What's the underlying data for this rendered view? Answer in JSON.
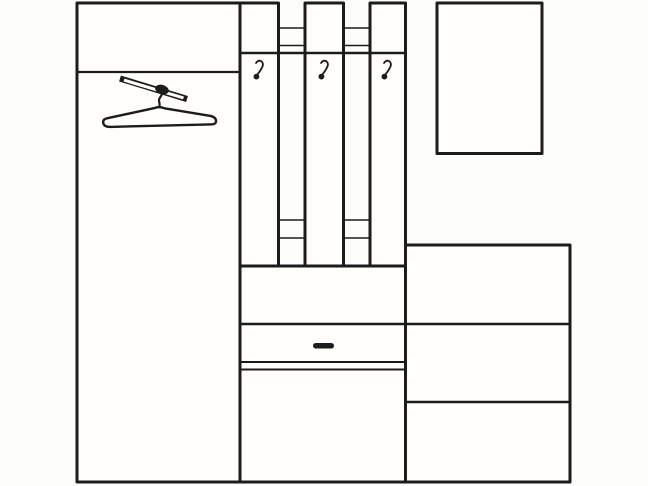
{
  "canvas": {
    "width": 648,
    "height": 486
  },
  "meta": {
    "background_color": "#fdfdfb",
    "line_color": "#1c1c1c",
    "panel_fill": "#fffefb",
    "drawing_kind": "hallway-furniture-line-drawing"
  },
  "drawing": {
    "shapes": [
      {
        "name": "wardrobe-body",
        "type": "rect",
        "x": 77,
        "y": 3,
        "w": 164,
        "h": 479,
        "sw": 3,
        "fill": "#fffefb"
      },
      {
        "name": "wardrobe-top-shelf-line",
        "type": "line",
        "x1": 77,
        "y1": 72,
        "x2": 241,
        "y2": 72,
        "sw": 2.2
      },
      {
        "name": "hanger-rod",
        "type": "line",
        "x1": 120,
        "y1": 78.5,
        "x2": 187,
        "y2": 99,
        "sw": 6.2,
        "cap": "butt"
      },
      {
        "name": "hanger-rod-core",
        "type": "line",
        "x1": 124,
        "y1": 80.1,
        "x2": 183.5,
        "y2": 97.9,
        "sw": 3,
        "cap": "butt",
        "stroke": "#fffefb"
      },
      {
        "name": "hanger-hook-collar",
        "type": "ellipse",
        "cx": 162,
        "cy": 89.5,
        "rx": 7,
        "ry": 4.6,
        "rot": 17,
        "fill": "#1c1c1c",
        "sw": 0
      },
      {
        "name": "hanger-hook-stem",
        "type": "path",
        "d": "M 161.5,92.5 C 163,96 158.5,97.5 159,100.5 C 159.4,102.8 159.8,104.5 159.6,107",
        "sw": 2.2
      },
      {
        "name": "hanger-body",
        "type": "path",
        "d": "M 107.5,118.2 L 155,107.9 Q 159.5,106.2 164.5,108.3 L 210.5,115.9 Q 216.4,117.3 216,121.6 Q 215.6,124.7 209.8,124.4 L 110.5,126.9 Q 103.6,127 103.1,122.4 Q 102.9,119.1 107.5,118.2 Z",
        "sw": 2.4,
        "fill": "#fffefb"
      },
      {
        "name": "rack-rail-top-upper-left",
        "type": "line",
        "x1": 278.5,
        "y1": 28,
        "x2": 305,
        "y2": 28,
        "sw": 1.6
      },
      {
        "name": "rack-rail-top-lower-left",
        "type": "line",
        "x1": 278.5,
        "y1": 45.5,
        "x2": 305,
        "y2": 45.5,
        "sw": 1.6
      },
      {
        "name": "rack-rail-top-upper-right",
        "type": "line",
        "x1": 343.5,
        "y1": 28,
        "x2": 370,
        "y2": 28,
        "sw": 1.6
      },
      {
        "name": "rack-rail-top-lower-right",
        "type": "line",
        "x1": 343.5,
        "y1": 45.5,
        "x2": 370,
        "y2": 45.5,
        "sw": 1.6
      },
      {
        "name": "rack-rail-bottom-upper-left",
        "type": "line",
        "x1": 278.5,
        "y1": 220,
        "x2": 305,
        "y2": 220,
        "sw": 1.6
      },
      {
        "name": "rack-rail-bottom-lower-left",
        "type": "line",
        "x1": 278.5,
        "y1": 238,
        "x2": 305,
        "y2": 238,
        "sw": 1.6
      },
      {
        "name": "rack-rail-bottom-upper-right",
        "type": "line",
        "x1": 343.5,
        "y1": 220,
        "x2": 370,
        "y2": 220,
        "sw": 1.6
      },
      {
        "name": "rack-rail-bottom-lower-right",
        "type": "line",
        "x1": 343.5,
        "y1": 238,
        "x2": 370,
        "y2": 238,
        "sw": 1.6
      },
      {
        "name": "coat-panel-1",
        "type": "rect",
        "x": 240,
        "y": 3,
        "w": 38.5,
        "h": 263,
        "sw": 3,
        "fill": "#fffefb"
      },
      {
        "name": "coat-panel-2",
        "type": "rect",
        "x": 305,
        "y": 3,
        "w": 38.5,
        "h": 263,
        "sw": 3,
        "fill": "#fffefb"
      },
      {
        "name": "coat-panel-3",
        "type": "rect",
        "x": 370,
        "y": 3,
        "w": 35.5,
        "h": 263,
        "sw": 3,
        "fill": "#fffefb"
      },
      {
        "name": "rack-crossbar-line",
        "type": "line",
        "x1": 240,
        "y1": 53,
        "x2": 405.5,
        "y2": 53,
        "sw": 2.6
      },
      {
        "name": "coat-hook-1-arm",
        "type": "path",
        "d": "M 256,63 Q 258.5,59.6 261.2,61.2 Q 264,63 262.4,66.6 Q 260.8,70.2 257.4,74.4",
        "sw": 1.8
      },
      {
        "name": "coat-hook-1-ball",
        "type": "circle",
        "cx": 256.4,
        "cy": 76.6,
        "r": 2.9,
        "fill": "#1c1c1c",
        "sw": 0
      },
      {
        "name": "coat-hook-2-arm",
        "type": "path",
        "d": "M 321,63 Q 323.5,59.6 326.2,61.2 Q 329,63 327.4,66.6 Q 325.8,70.2 322.4,74.4",
        "sw": 1.8
      },
      {
        "name": "coat-hook-2-ball",
        "type": "circle",
        "cx": 321.4,
        "cy": 76.6,
        "r": 2.9,
        "fill": "#1c1c1c",
        "sw": 0
      },
      {
        "name": "coat-hook-3-arm",
        "type": "path",
        "d": "M 384,63 Q 386.5,59.6 389.2,61.2 Q 392,63 390.4,66.6 Q 388.8,70.2 385.4,74.4",
        "sw": 1.8
      },
      {
        "name": "coat-hook-3-ball",
        "type": "circle",
        "cx": 384.4,
        "cy": 76.6,
        "r": 2.9,
        "fill": "#1c1c1c",
        "sw": 0
      },
      {
        "name": "lower-cabinet-body",
        "type": "rect",
        "x": 240,
        "y": 266,
        "w": 165.5,
        "h": 216,
        "sw": 3,
        "fill": "#fffefb"
      },
      {
        "name": "drawer-top-line",
        "type": "line",
        "x1": 240,
        "y1": 324,
        "x2": 405.5,
        "y2": 324,
        "sw": 2.4
      },
      {
        "name": "drawer-bottom-line",
        "type": "line",
        "x1": 240,
        "y1": 362,
        "x2": 405.5,
        "y2": 362,
        "sw": 2
      },
      {
        "name": "cabinet-door-top-line",
        "type": "line",
        "x1": 240,
        "y1": 369.5,
        "x2": 405.5,
        "y2": 369.5,
        "sw": 2
      },
      {
        "name": "drawer-handle",
        "type": "rect",
        "x": 313,
        "y": 343,
        "w": 21,
        "h": 5.5,
        "rx": 2.7,
        "fill": "#1c1c1c",
        "sw": 0
      },
      {
        "name": "right-unit-body",
        "type": "rect",
        "x": 405.5,
        "y": 245,
        "w": 164.5,
        "h": 237,
        "sw": 3,
        "fill": "#fffefb"
      },
      {
        "name": "right-unit-divider-upper",
        "type": "line",
        "x1": 405.5,
        "y1": 324,
        "x2": 570,
        "y2": 324,
        "sw": 2.4
      },
      {
        "name": "right-unit-divider-lower",
        "type": "line",
        "x1": 405.5,
        "y1": 402,
        "x2": 570,
        "y2": 402,
        "sw": 2.4
      },
      {
        "name": "mirror-frame",
        "type": "rect",
        "x": 437,
        "y": 3,
        "w": 105,
        "h": 150.5,
        "sw": 3,
        "fill": "#fffefb"
      }
    ]
  }
}
